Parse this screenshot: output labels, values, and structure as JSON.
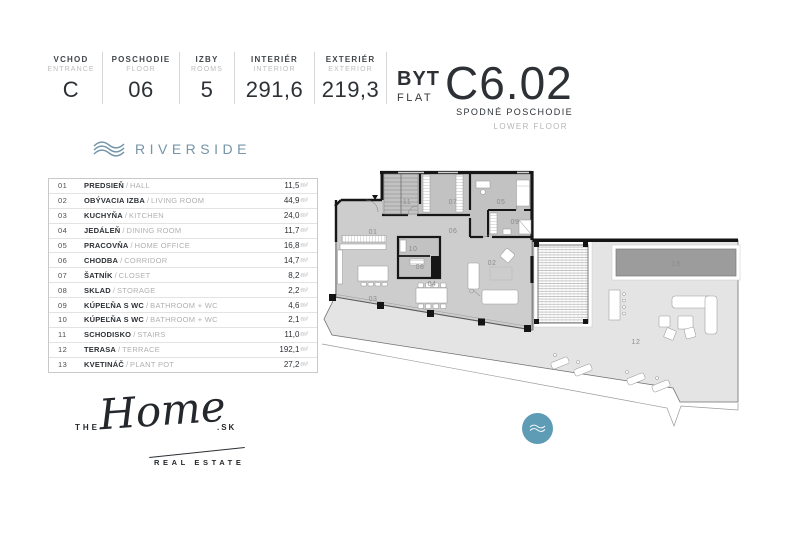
{
  "header": {
    "info_boxes": [
      {
        "label": "VCHOD",
        "sublabel": "ENTRANCE",
        "value": "C"
      },
      {
        "label": "POSCHODIE",
        "sublabel": "FLOOR",
        "value": "06"
      },
      {
        "label": "IZBY",
        "sublabel": "ROOMS",
        "value": "5"
      },
      {
        "label": "INTERIÉR",
        "sublabel": "INTERIOR",
        "value": "291,6"
      },
      {
        "label": "EXTERIÉR",
        "sublabel": "EXTERIOR",
        "value": "219,3"
      }
    ],
    "flat": {
      "type_sk": "BYT",
      "type_en": "FLAT",
      "number": "C6.02",
      "floor_sk": "SPODNÉ POSCHODIE",
      "floor_en": "LOWER FLOOR"
    }
  },
  "brand": {
    "name": "RIVERSIDE"
  },
  "rooms": {
    "separator": "/",
    "area_unit": "m²",
    "items": [
      {
        "num": "01",
        "name_sk": "PREDSIEŇ",
        "name_en": "HALL",
        "area": "11,5"
      },
      {
        "num": "02",
        "name_sk": "OBÝVACIA IZBA",
        "name_en": "LIVING ROOM",
        "area": "44,9"
      },
      {
        "num": "03",
        "name_sk": "KUCHYŇA",
        "name_en": "KITCHEN",
        "area": "24,0"
      },
      {
        "num": "04",
        "name_sk": "JEDÁLEŇ",
        "name_en": "DINING ROOM",
        "area": "11,7"
      },
      {
        "num": "05",
        "name_sk": "PRACOVŇA",
        "name_en": "HOME OFFICE",
        "area": "16,8"
      },
      {
        "num": "06",
        "name_sk": "CHODBA",
        "name_en": "CORRIDOR",
        "area": "14,7"
      },
      {
        "num": "07",
        "name_sk": "ŠATNÍK",
        "name_en": "CLOSET",
        "area": "8,2"
      },
      {
        "num": "08",
        "name_sk": "SKLAD",
        "name_en": "STORAGE",
        "area": "2,2"
      },
      {
        "num": "09",
        "name_sk": "KÚPEĽŇA S WC",
        "name_en": "BATHROOM + WC",
        "area": "4,6"
      },
      {
        "num": "10",
        "name_sk": "KÚPEĽŇA S WC",
        "name_en": "BATHROOM + WC",
        "area": "2,1"
      },
      {
        "num": "11",
        "name_sk": "SCHODISKO",
        "name_en": "STAIRS",
        "area": "11,0"
      },
      {
        "num": "12",
        "name_sk": "TERASA",
        "name_en": "TERRACE",
        "area": "192,1"
      },
      {
        "num": "13",
        "name_sk": "KVETINÁČ",
        "name_en": "PLANT POT",
        "area": "27,2"
      }
    ]
  },
  "agency_logo": {
    "prefix": "THE",
    "word": "Home",
    "suffix": ".SK",
    "tagline": "REAL ESTATE"
  },
  "colors": {
    "accent_blue": "#7595a8",
    "wave_circle": "#5e9cb6",
    "plan_interior": "#cdcdcd",
    "plan_terrace": "#e4e4e4",
    "plan_planter": "#9c9c9c"
  }
}
